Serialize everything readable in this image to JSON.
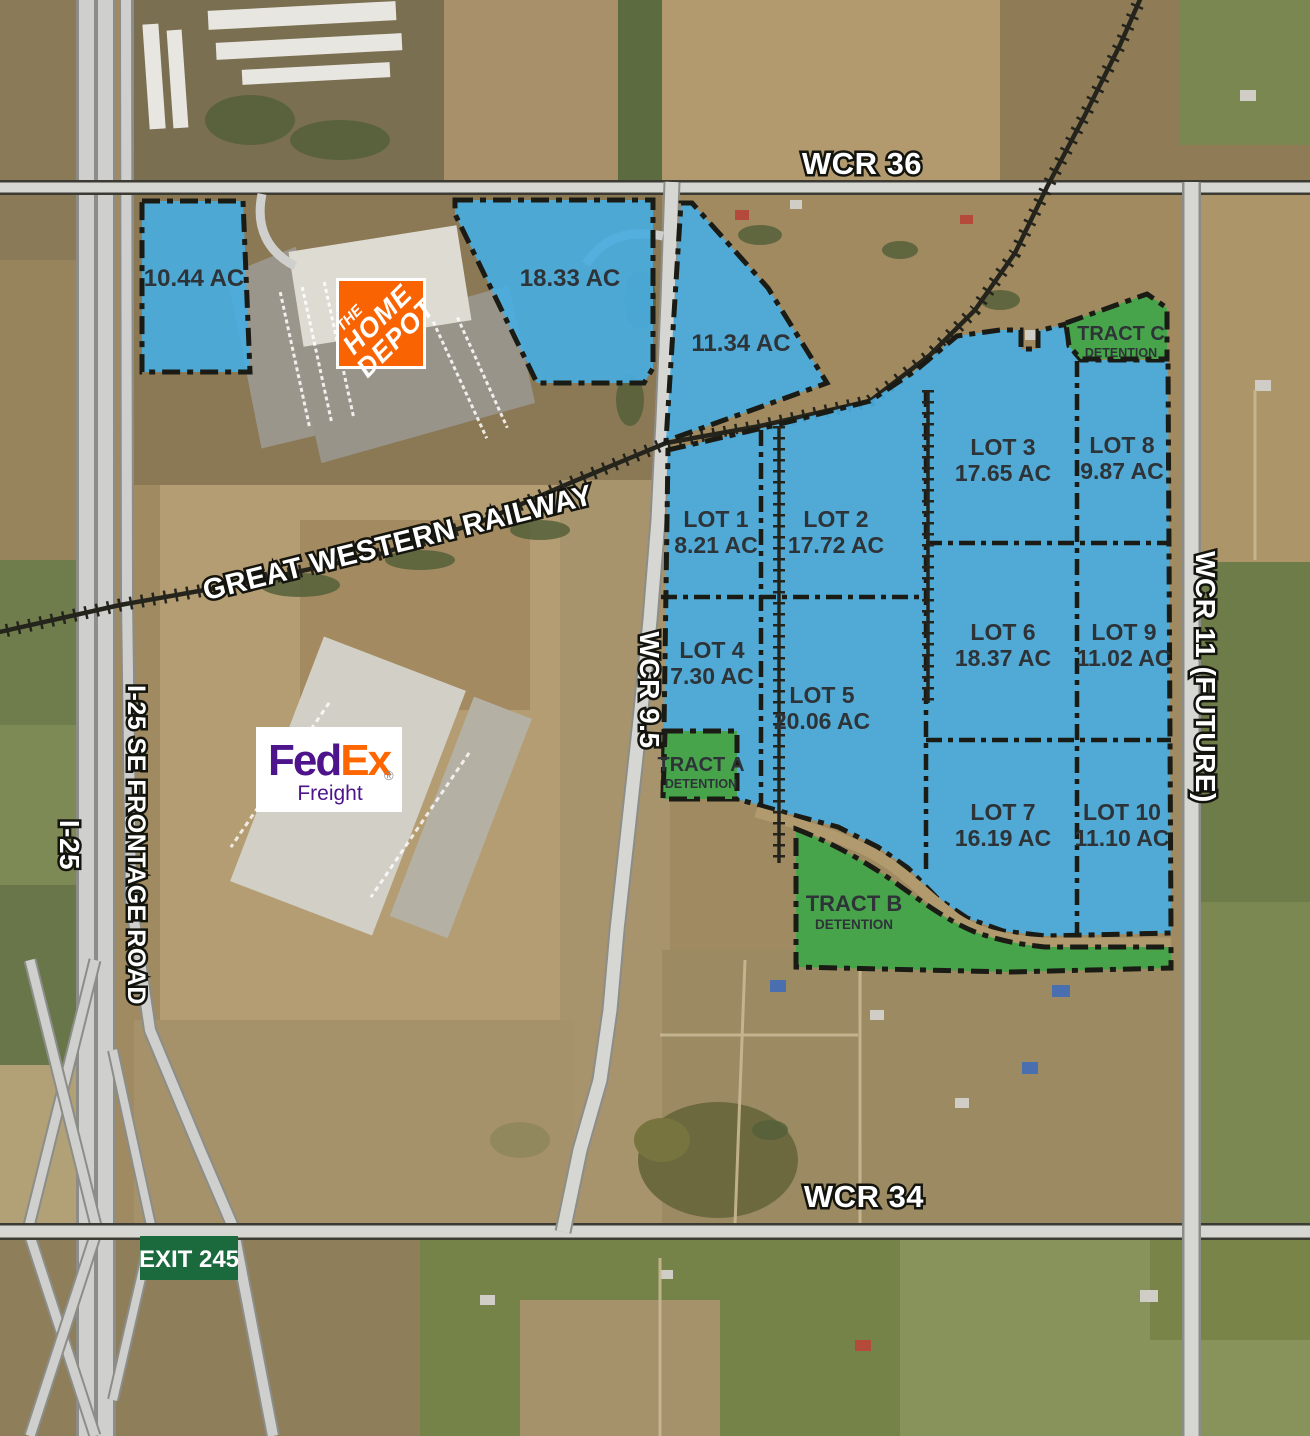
{
  "map_title": "Aerial site plan map",
  "roads": {
    "wcr36": "WCR 36",
    "wcr34": "WCR 34",
    "wcr95": "WCR 9.5",
    "wcr11": "WCR 11 (FUTURE)",
    "i25": "I-25",
    "frontage": "I-25 SE FRONTAGE ROAD",
    "railway": "GREAT WESTERN RAILWAY",
    "exit_sign": "EXIT 245"
  },
  "parcels": [
    {
      "name": "",
      "acreage": "10.44 AC"
    },
    {
      "name": "",
      "acreage": "18.33 AC"
    },
    {
      "name": "",
      "acreage": "11.34 AC"
    },
    {
      "name": "LOT 1",
      "acreage": "8.21 AC"
    },
    {
      "name": "LOT 2",
      "acreage": "17.72 AC"
    },
    {
      "name": "LOT 3",
      "acreage": "17.65 AC"
    },
    {
      "name": "LOT 4",
      "acreage": "7.30 AC"
    },
    {
      "name": "LOT 5",
      "acreage": "20.06 AC"
    },
    {
      "name": "LOT 6",
      "acreage": "18.37 AC"
    },
    {
      "name": "LOT 7",
      "acreage": "16.19 AC"
    },
    {
      "name": "LOT 8",
      "acreage": "9.87 AC"
    },
    {
      "name": "LOT 9",
      "acreage": "11.02 AC"
    },
    {
      "name": "LOT 10",
      "acreage": "11.10 AC"
    }
  ],
  "tracts": [
    {
      "name": "TRACT A",
      "type": "DETENTION"
    },
    {
      "name": "TRACT B",
      "type": "DETENTION"
    },
    {
      "name": "TRACT C",
      "type": "DETENTION"
    }
  ],
  "logos": {
    "home_depot": {
      "line1": "THE",
      "line2": "HOME",
      "line3": "DEPOT"
    },
    "fedex": {
      "fed": "Fed",
      "ex": "Ex",
      "reg": "®",
      "freight": "Freight"
    }
  },
  "colors": {
    "parcel_blue": "#49ACDF",
    "tract_green": "#47A44B",
    "exit_green": "#1A6A3E",
    "home_depot_orange": "#F96302",
    "fedex_purple": "#4D148C",
    "fedex_orange": "#FF6600"
  }
}
